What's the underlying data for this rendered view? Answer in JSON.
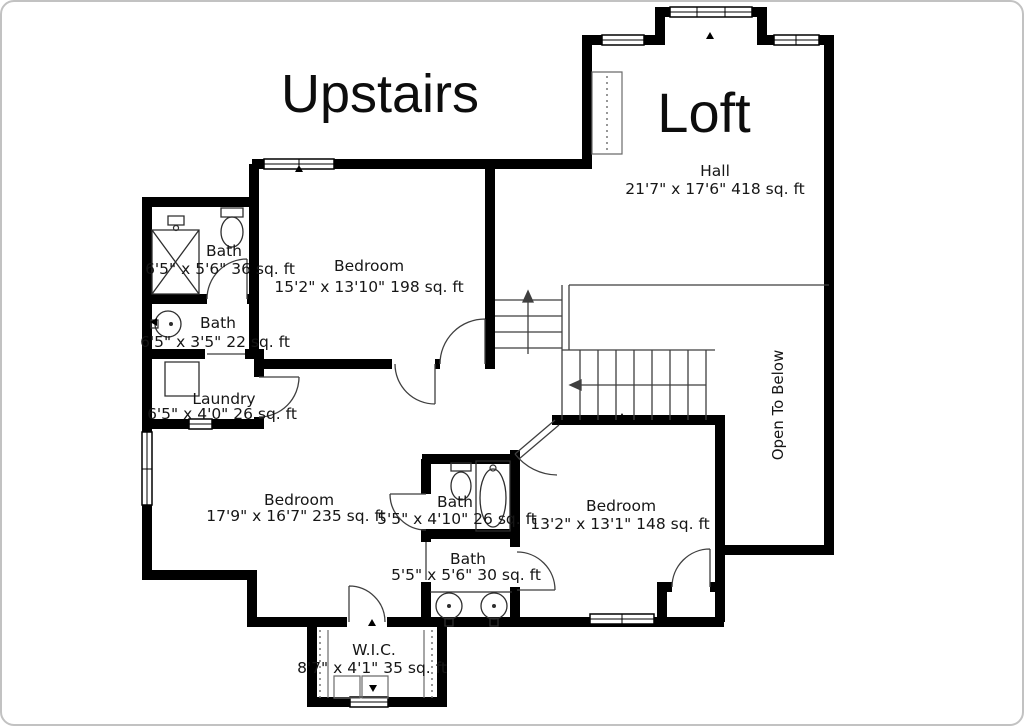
{
  "titles": {
    "upstairs": "Upstairs",
    "loft": "Loft"
  },
  "rooms": {
    "hall": {
      "name": "Hall",
      "dims": "21'7\" x 17'6\" 418 sq. ft"
    },
    "bath_upper": {
      "name": "Bath",
      "dims": "6'5\" x 5'6\" 36 sq. ft"
    },
    "bedroom_upper": {
      "name": "Bedroom",
      "dims": "15'2\" x 13'10\" 198 sq. ft"
    },
    "bath_mid": {
      "name": "Bath",
      "dims": "6'5\" x 3'5\" 22 sq. ft"
    },
    "laundry": {
      "name": "Laundry",
      "dims": "6'5\" x 4'0\" 26 sq. ft"
    },
    "bedroom_left": {
      "name": "Bedroom",
      "dims": "17'9\" x 16'7\" 235 sq. ft"
    },
    "bath_center": {
      "name": "Bath",
      "dims": "5'5\" x 4'10\" 26 sq. ft"
    },
    "bedroom_right": {
      "name": "Bedroom",
      "dims": "13'2\" x 13'1\" 148 sq. ft"
    },
    "bath_lower": {
      "name": "Bath",
      "dims": "5'5\" x 5'6\" 30 sq. ft"
    },
    "wic": {
      "name": "W.I.C.",
      "dims": "8'7\" x 4'1\" 35 sq. ft"
    }
  },
  "annotations": {
    "open_to_below": "Open To Below"
  },
  "colors": {
    "wall": "#000000",
    "thin_line": "#3f3f3f",
    "text": "#161616",
    "background": "#ffffff",
    "frame_border": "#c2c2c2"
  }
}
